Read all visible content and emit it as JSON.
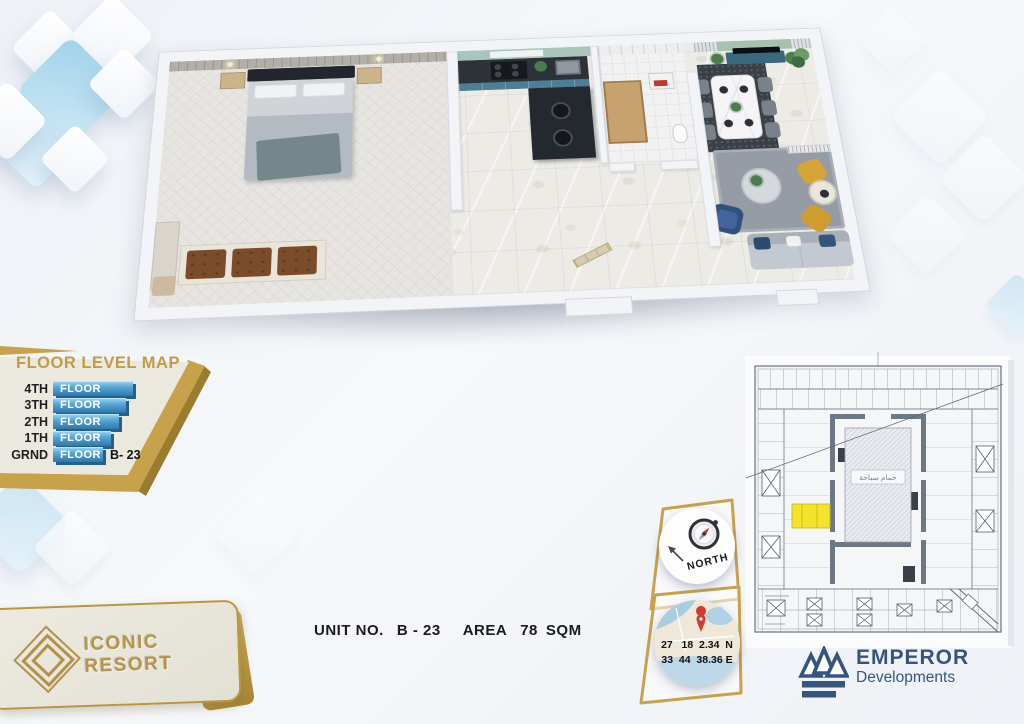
{
  "floor_level_map": {
    "title": "FLOOR LEVEL MAP",
    "rows": [
      {
        "label": "4TH",
        "bar_label": "FLOOR",
        "suffix": "",
        "bar_width": 80
      },
      {
        "label": "3TH",
        "bar_label": "FLOOR",
        "suffix": "",
        "bar_width": 73
      },
      {
        "label": "2TH",
        "bar_label": "FLOOR",
        "suffix": "",
        "bar_width": 66
      },
      {
        "label": "1TH",
        "bar_label": "FLOOR",
        "suffix": "",
        "bar_width": 58
      },
      {
        "label": "GRND",
        "bar_label": "FLOOR",
        "suffix": "B- 23",
        "bar_width": 50
      }
    ]
  },
  "unit_bar": {
    "unit_label": "UNIT NO.",
    "unit_value": "B - 23",
    "area_label": "AREA",
    "area_value": "78",
    "area_unit": "SQM"
  },
  "compass": {
    "label": "NORTH"
  },
  "location": {
    "line1": "27   18  2.34  N",
    "line2": "33  44  38.36 E"
  },
  "site_plan": {
    "courtyard_label": "حمام سباحة"
  },
  "brand_card": {
    "name": "ICONIC RESORT"
  },
  "developer": {
    "name": "EMPEROR",
    "subtitle": "Developments"
  },
  "colors": {
    "gold": "#bf9c45",
    "bar_blue": "#2f7cb2",
    "navy": "#35567c",
    "highlight_yellow": "#f4e32b",
    "sage": "#a6c2af",
    "cabinet_blue": "#4d7e96"
  }
}
